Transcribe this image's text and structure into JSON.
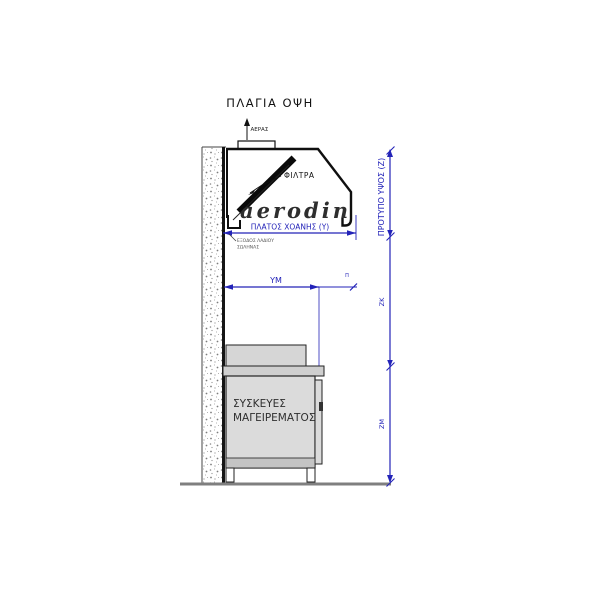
{
  "title": "ΠΛΑΓΙΑ ΟΨΗ",
  "hood": {
    "air_label": "ΑΕΡΑΣ",
    "filters_label": "ΦΙΛΤΡΑ",
    "brand": "aerodin",
    "width_dim": "ΠΛΑΤΟΣ ΧΟΑΝΗΣ (Υ)",
    "oil_note_line1": "ΕΞΟΔΟΣ ΛΑΔΙΟΥ",
    "oil_note_line2": "ΣΩΛΗΝΑΣ"
  },
  "appliance": {
    "label_line1": "ΣΥΣΚΕΥΕΣ",
    "label_line2": "ΜΑΓΕΙΡΕΜΑΤΟΣ"
  },
  "dimensions": {
    "horizontal": "ΥΜ",
    "overhang": "Π",
    "standard_height": "ΠΡΟΤΥΠΟ ΥΨΟΣ (Ζ)",
    "upper_segment": "ΖΚ",
    "lower_segment": "ΖΜ"
  },
  "colors": {
    "line": "#1a1a1a",
    "dimension_blue": "#2323b8",
    "appliance_fill": "#dbdbdb",
    "ground_gray": "#7f7f7f",
    "brand_color": "#2e2e2e"
  }
}
